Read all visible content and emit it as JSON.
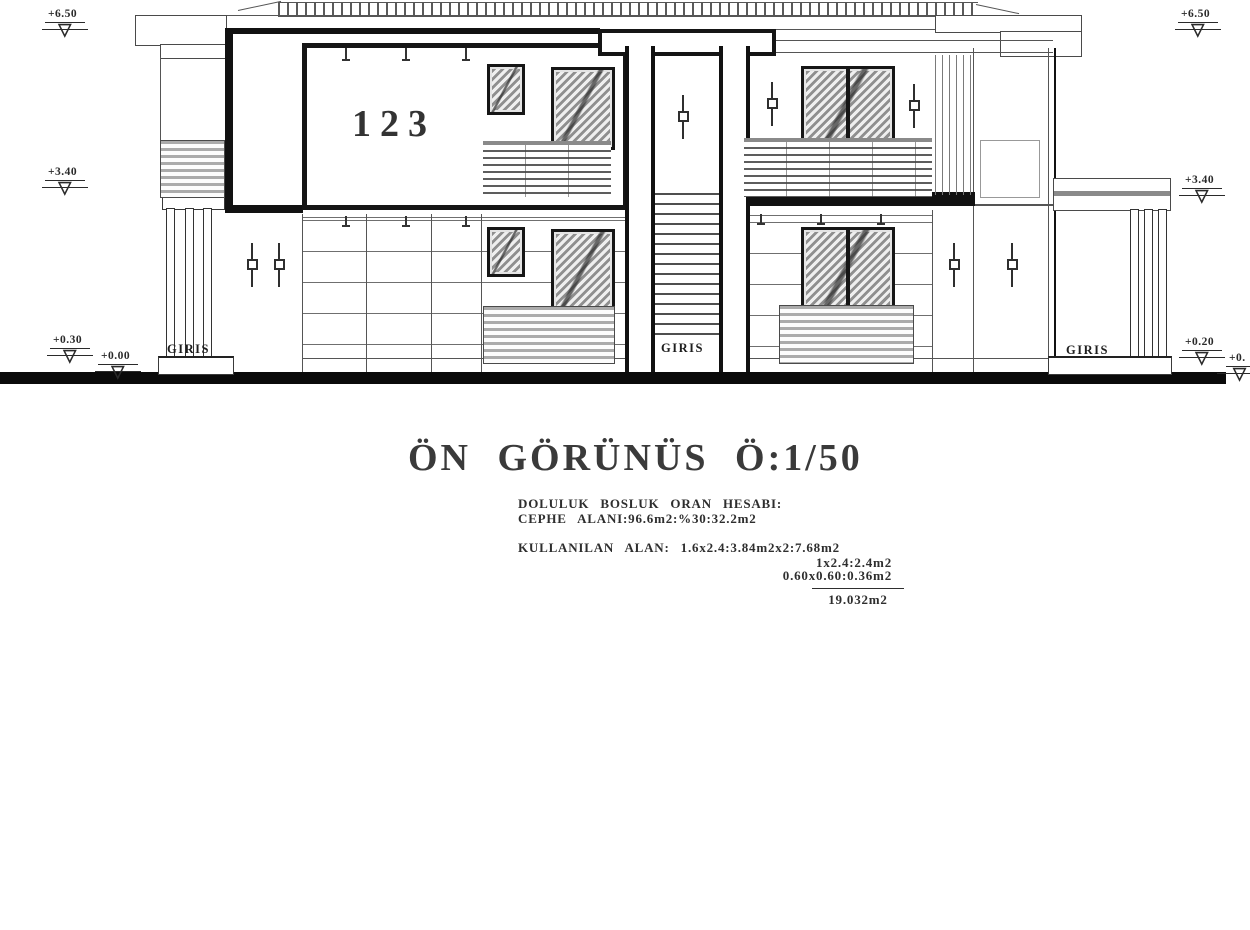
{
  "drawing": {
    "title": "ÖN GÖRÜNÜS Ö:1/50",
    "room_number": "123",
    "entrance_labels": [
      "GIRIS",
      "GIRIS",
      "GIRIS"
    ],
    "elevation_markers": [
      "+6.50",
      "+6.50",
      "+3.40",
      "+3.40",
      "+0.30",
      "+0.00",
      "+0.20",
      "+0."
    ],
    "notes": {
      "heading": "DOLULUK BOSLUK ORAN HESABI:",
      "facade_area": "CEPHE ALANI:96.6m2:%30:32.2m2",
      "used_area": "KULLANILAN ALAN: 1.6x2.4:3.84m2x2:7.68m2",
      "used_area_2": "1x2.4:2.4m2",
      "used_area_3": "0.60x0.60:0.36m2",
      "total": "19.032m2"
    },
    "colors": {
      "ink": "#2a2a2a",
      "hatch_gray": "#8f8f8f",
      "ground": "#0a0a0a"
    }
  }
}
